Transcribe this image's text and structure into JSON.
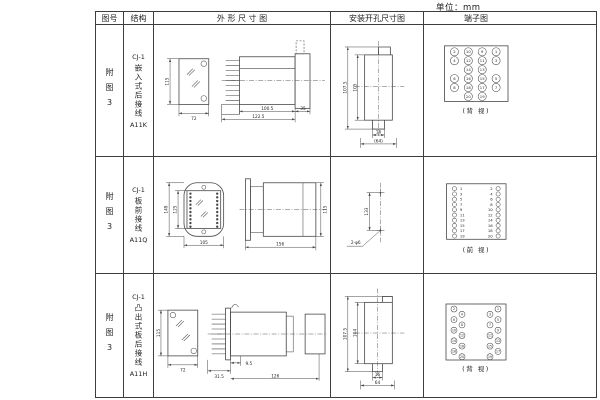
{
  "unit_label": "单位：mm",
  "line_color": "#474747",
  "headers": {
    "fig_no": "图号",
    "structure": "结构",
    "outline": "外 形 尺 寸 图",
    "mounting": "安装开孔尺寸图",
    "terminal": "端子图"
  },
  "rows": [
    {
      "fig_no": "附图3",
      "model": "CJ-1",
      "mount_type": "嵌入式后接线",
      "code": "A11K",
      "outline": {
        "front_h": "115",
        "front_w": "72",
        "body_len": "100.5",
        "total_len": "122.5",
        "flange_w": "35"
      },
      "mount": {
        "outer_h": "107.5",
        "inner_h": "105",
        "slot_w": "16",
        "total_w": "(64)"
      },
      "terminal": {
        "caption": "(背 视)",
        "layout": "grid",
        "cells": [
          [
            "2",
            "10",
            "9",
            "1"
          ],
          [
            "4",
            "12",
            "11",
            "3"
          ],
          [
            null,
            "14",
            "13",
            null
          ],
          [
            "6",
            "16",
            "15",
            "5"
          ],
          [
            "8",
            "18",
            "17",
            "7"
          ],
          [
            null,
            "20",
            "19",
            null
          ]
        ]
      }
    },
    {
      "fig_no": "附图3",
      "model": "CJ-1",
      "mount_type": "板前接线",
      "code": "A11Q",
      "outline": {
        "outer_h": "149",
        "inner_h": "125",
        "front_w": "105",
        "body_len": "156",
        "side_h": "115"
      },
      "mount": {
        "hole_dist": "133",
        "holes": "2-φ6"
      },
      "terminal": {
        "caption": "(前 视)",
        "layout": "pairs",
        "left": [
          "1",
          "3",
          "5",
          "7",
          "9",
          "11",
          "13",
          "15",
          "17",
          "19"
        ],
        "right": [
          "2",
          "4",
          "6",
          "8",
          "10",
          "12",
          "14",
          "16",
          "18",
          "20"
        ]
      }
    },
    {
      "fig_no": "附图3",
      "model": "CJ-1",
      "mount_type": "凸出式板后接线",
      "code": "A11H",
      "outline": {
        "front_h": "115",
        "front_w": "72",
        "fin_len": "31.5",
        "stud_len": "9.5",
        "body_len": "126"
      },
      "mount": {
        "outer_h": "107.5",
        "inner_h": "104",
        "slot_w": "16",
        "total_w": "64"
      },
      "terminal": {
        "caption": "(背 视)",
        "layout": "staggered",
        "left": [
          "2",
          "4",
          "6",
          "8",
          "10",
          "12",
          "14",
          "16",
          "18",
          "20"
        ],
        "right": [
          "1",
          "3",
          "5",
          "7",
          "9",
          "11",
          "13",
          "15",
          "17",
          "19"
        ]
      }
    }
  ]
}
